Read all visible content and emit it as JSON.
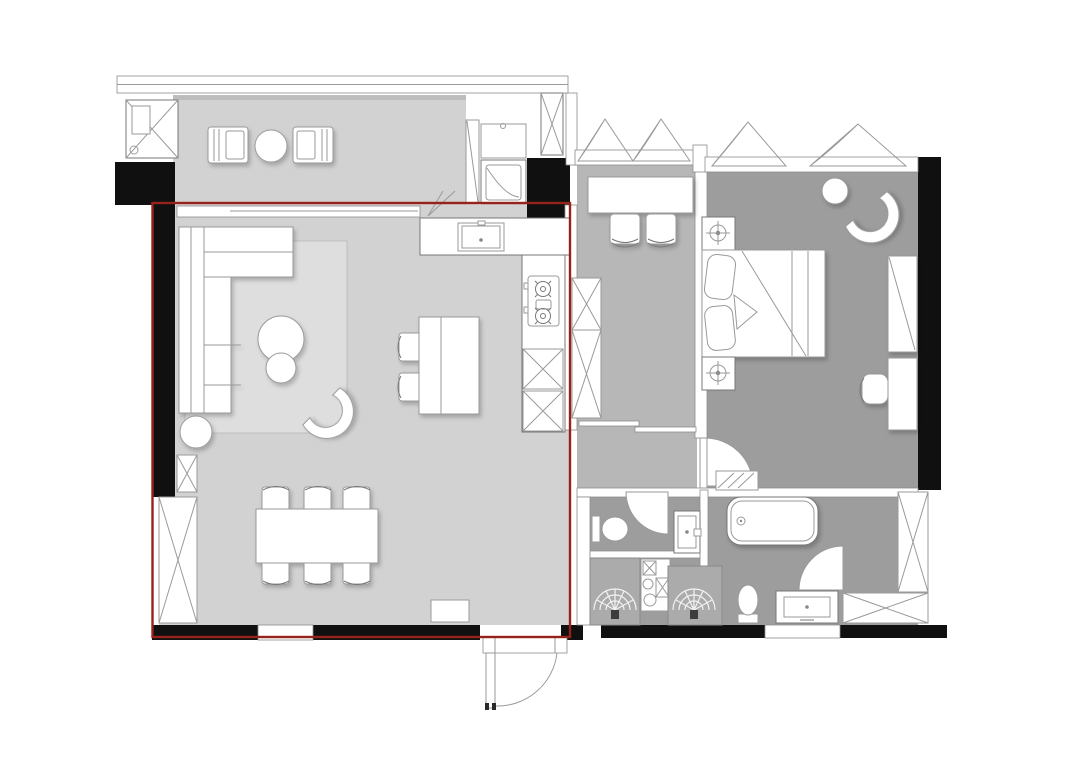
{
  "title": "apartment-floor-plan",
  "colors": {
    "bg": "#ffffff",
    "wall": "#101010",
    "red": "#96231b",
    "floor-living": "#d2d2d2",
    "floor-study": "#b7b7b7",
    "floor-bedroom": "#9d9d9d",
    "rug": "#dedede",
    "stall": "#ababab",
    "furn-fill": "#ffffff",
    "furn-stroke": "#9a9a9a",
    "line-dark": "#777777"
  },
  "highlight": {
    "region": "living-dining-kitchen",
    "color": "#96231b",
    "shape": "rectangle-outline"
  },
  "rooms": [
    {
      "name": "balcony",
      "floor": "floor-living",
      "furniture": [
        "ac-unit",
        "lounge-chair-left",
        "balcony-table",
        "lounge-chair-right",
        "balcony-cabinet",
        "railing"
      ]
    },
    {
      "name": "living-dining-kitchen",
      "floor": "floor-living",
      "highlighted": true,
      "furniture": [
        "sofa",
        "rug",
        "ottoman",
        "coffee-table-large",
        "coffee-table-small",
        "lounge-armchair",
        "side-table",
        "work-table",
        "work-chairs",
        "dining-table",
        "dining-chairs-x6",
        "storage-cabinets",
        "doormat",
        "kitchen-counter",
        "sink",
        "stove",
        "kitchen-cabinets",
        "fridge",
        "entry-door"
      ]
    },
    {
      "name": "study",
      "floor": "floor-study",
      "furniture": [
        "desk",
        "desk-chairs-x2",
        "tall-cabinets",
        "casement-windows-x2",
        "sliding-door"
      ]
    },
    {
      "name": "bedroom",
      "floor": "floor-bedroom",
      "furniture": [
        "double-bed",
        "pillows",
        "nightstands-x2",
        "lamps-x2",
        "round-table",
        "armchair",
        "dresser",
        "vanity-chair",
        "casement-windows-x2",
        "closets"
      ]
    },
    {
      "name": "guest-bathroom",
      "floor": "floor-bedroom",
      "furniture": [
        "toilet",
        "door",
        "vanity",
        "shower-stalls-x2",
        "laundry-stack"
      ]
    },
    {
      "name": "master-bathroom",
      "floor": "floor-bedroom",
      "furniture": [
        "bathtub",
        "door",
        "toilet",
        "vanity",
        "towel-radiator",
        "closet"
      ]
    }
  ]
}
